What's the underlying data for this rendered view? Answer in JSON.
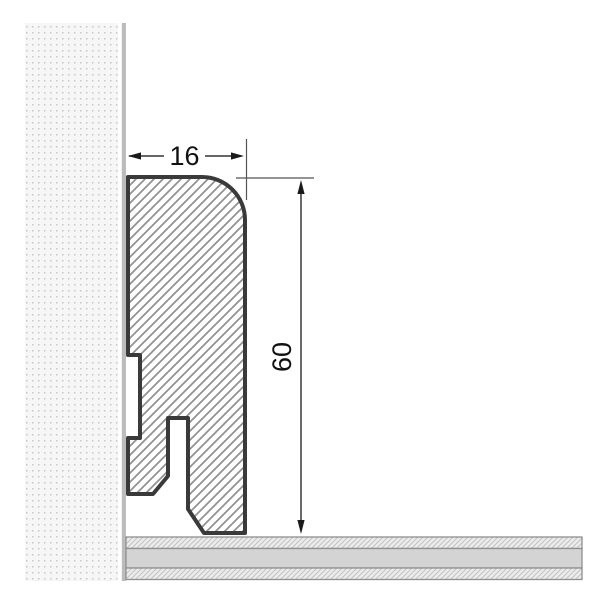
{
  "diagram": {
    "type": "technical-cross-section",
    "subject": "skirting-board-profile-against-wall-on-floor",
    "dimension_width": {
      "value": "16"
    },
    "dimension_height": {
      "value": "60"
    },
    "colors": {
      "background": "#ffffff",
      "profile_outline": "#3a3a3a",
      "profile_hatch_line": "#909090",
      "wall_background": "#f6f6f6",
      "wall_dot": "#c6c6c6",
      "wall_surface_line": "#bcbcbc",
      "floor_core_fill": "#d4d4d4",
      "floor_hatch_background": "#ececec",
      "floor_hatch_line": "#c2c2c2",
      "floor_border": "#8f8f8f",
      "dimension_line": "#555555",
      "dimension_text": "#111111"
    }
  }
}
